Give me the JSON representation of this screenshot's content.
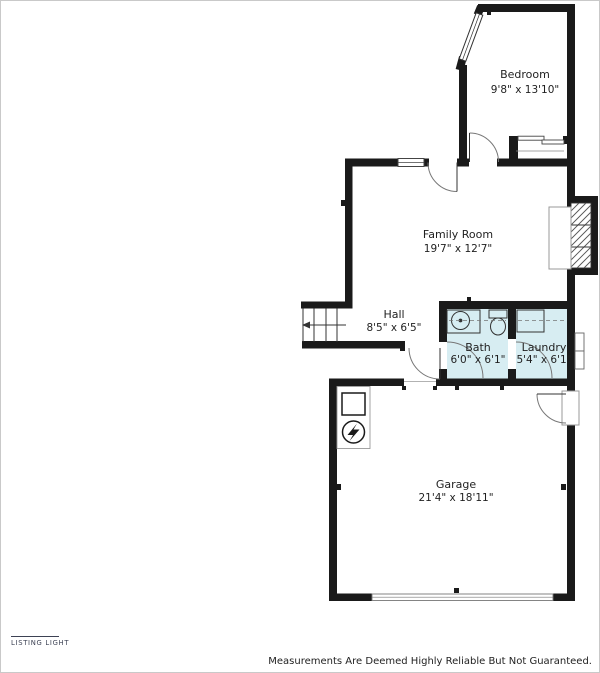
{
  "footer": {
    "brand": "LISTING LIGHT",
    "disclaimer": "Measurements Are Deemed Highly Reliable But Not Guaranteed."
  },
  "colors": {
    "wall": "#1a1a1a",
    "wet_room_fill": "#d7edf2",
    "thin_line": "#444444",
    "text": "#1f1f1f",
    "brand": "#3d4254"
  },
  "rooms": {
    "bedroom": {
      "name": "Bedroom",
      "dims": "9'8\" x 13'10\""
    },
    "family_room": {
      "name": "Family Room",
      "dims": "19'7\" x 12'7\""
    },
    "hall": {
      "name": "Hall",
      "dims": "8'5\" x 6'5\""
    },
    "bath": {
      "name": "Bath",
      "dims": "6'0\" x 6'1\""
    },
    "laundry": {
      "name": "Laundry",
      "dims": "5'4\" x 6'1\""
    },
    "garage": {
      "name": "Garage",
      "dims": "21'4\" x 18'11\""
    }
  },
  "fixtures": [
    "stairs",
    "fireplace",
    "closet-sliding-door",
    "sink",
    "toilet",
    "washer",
    "furnace",
    "water-heater",
    "garage-door"
  ]
}
